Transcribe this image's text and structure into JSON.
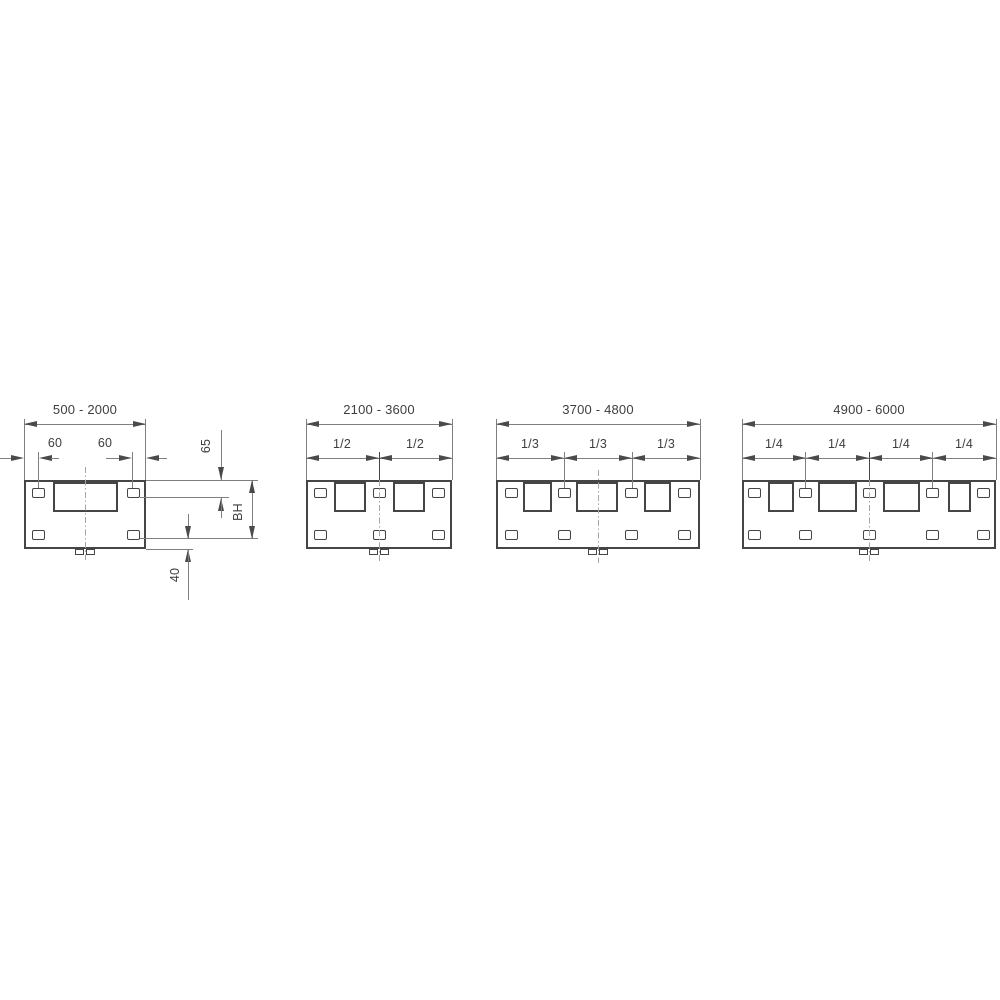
{
  "title": "mounting plate dimension diagrams",
  "colors": {
    "background": "#ffffff",
    "shape_line": "#454545",
    "dimension_line": "#7f7f7f",
    "arrow": "#4a4a4a",
    "centerline": "#a6a6a6",
    "text": "#3e3e3e"
  },
  "diagrams": [
    {
      "range": "500 - 2000",
      "labels": {
        "left_slot_offset": "60",
        "right_slot_offset": "60",
        "top_edge_to_slot": "65",
        "mounting_height": "BH",
        "slot_to_bottom_edge": "40"
      }
    },
    {
      "range": "2100 - 3600",
      "fractions": [
        "1/2",
        "1/2"
      ]
    },
    {
      "range": "3700 - 4800",
      "fractions": [
        "1/3",
        "1/3",
        "1/3"
      ]
    },
    {
      "range": "4900 - 6000",
      "fractions": [
        "1/4",
        "1/4",
        "1/4",
        "1/4"
      ]
    }
  ]
}
